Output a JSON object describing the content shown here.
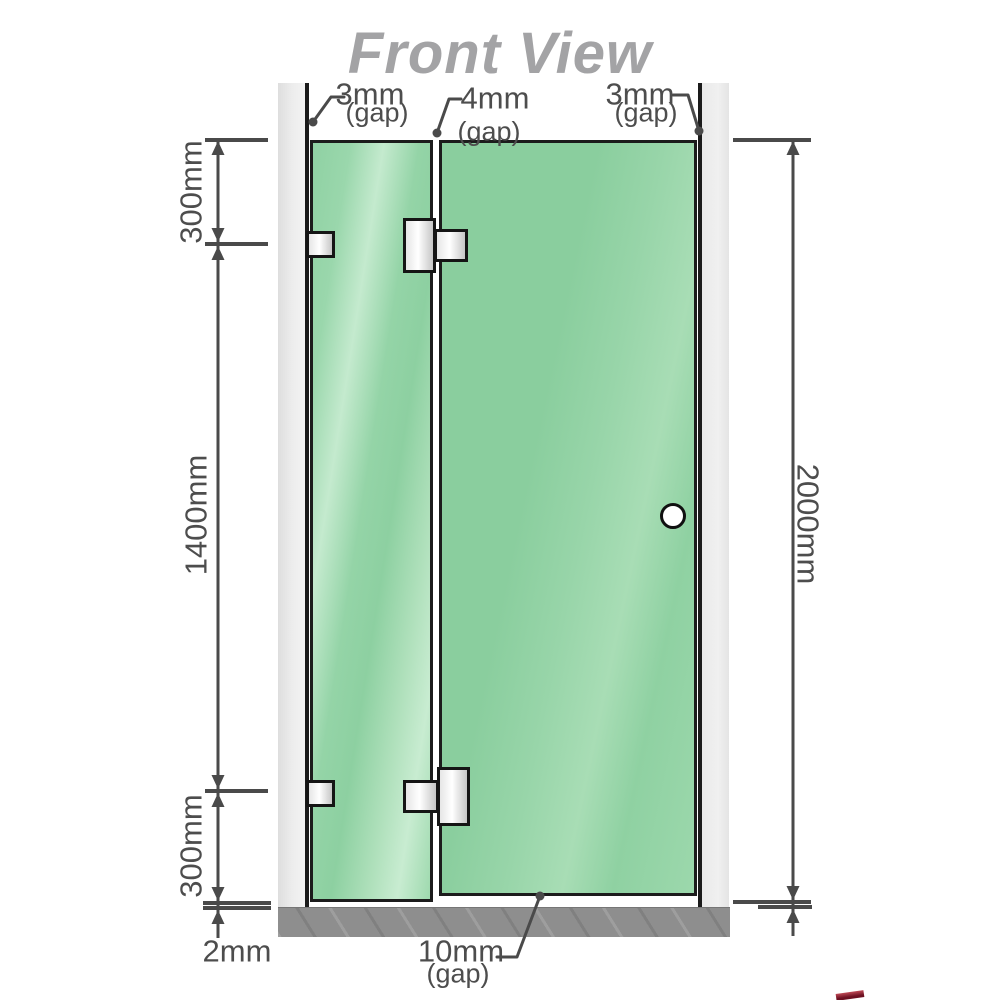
{
  "title": "Front View",
  "dimensions": {
    "gap_top_left": {
      "value": "3mm",
      "qualifier": "(gap)"
    },
    "gap_middle": {
      "value": "4mm",
      "qualifier": "(gap)"
    },
    "gap_top_right": {
      "value": "3mm",
      "qualifier": "(gap)"
    },
    "gap_bottom": {
      "value": "10mm",
      "qualifier": "(gap)"
    },
    "left_top_segment": "300mm",
    "left_middle_segment": "1400mm",
    "left_bottom_segment": "300mm",
    "right_total_height": "2000mm",
    "floor_clearance": "2mm"
  },
  "colors": {
    "glass": "#8ED1A4",
    "glass_highlight": "#C4EACE",
    "outline": "#1C1C1C",
    "wall_post": "#EAEAEA",
    "floor": "#8E8E8E",
    "dimension_line": "#4A4A4A",
    "label_text": "#4D4D4D",
    "title_text": "#A3A3A5",
    "hardware_metal": "#E6E6E6"
  }
}
